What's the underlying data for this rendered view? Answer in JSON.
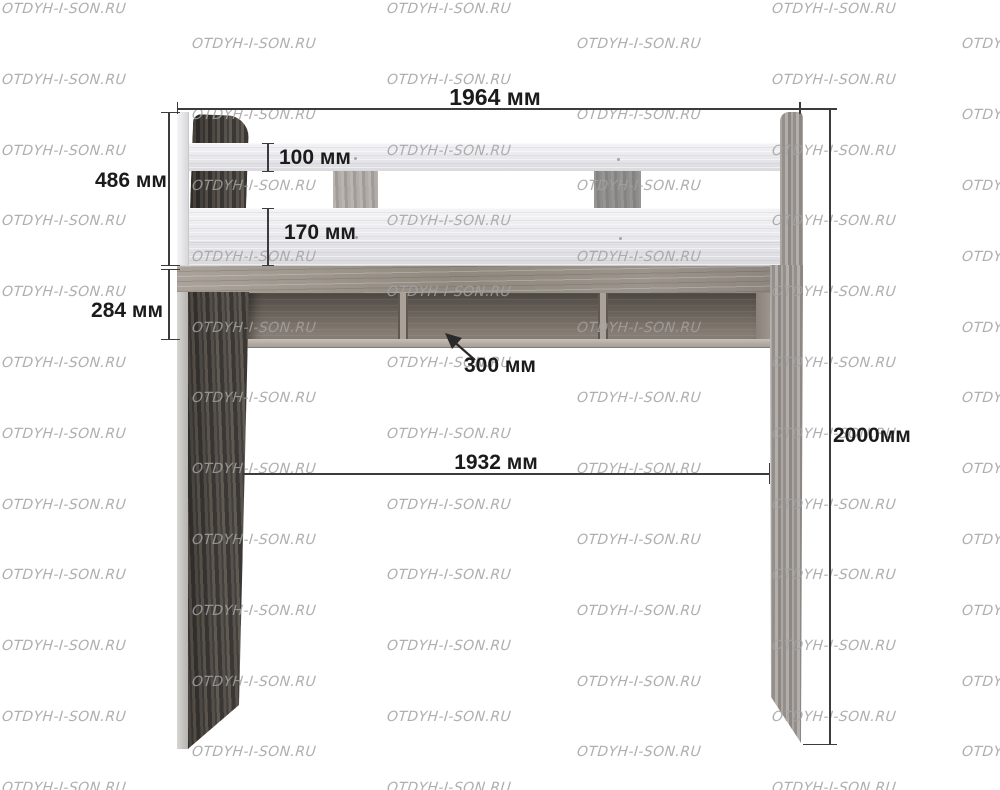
{
  "watermark": {
    "text": "OTDYH-I-SON.RU"
  },
  "dimensions": {
    "top_width": "1964 мм",
    "rail_section_height": "486 мм",
    "top_rail_height": "100 мм",
    "lower_rail_height": "170 мм",
    "under_platform_shelf_height": "284 мм",
    "shelf_depth": "300 мм",
    "inner_width": "1932 мм",
    "total_height": "2000мм"
  },
  "colors": {
    "line": "#3c3c3c",
    "label": "#1b1b1b",
    "watermark": "#a2a2a2"
  }
}
